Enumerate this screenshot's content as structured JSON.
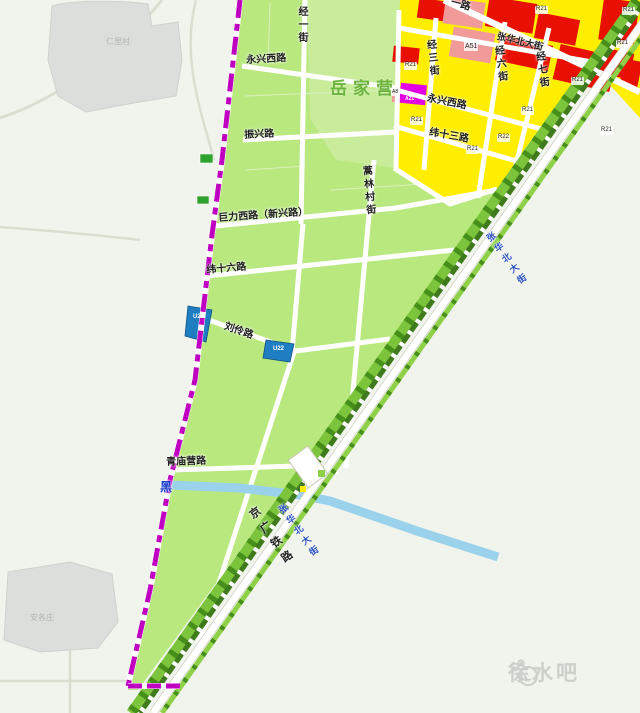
{
  "villages": {
    "yuejiaying": "岳家营",
    "renlicun": "仁里村",
    "angezhuang": "安各庄"
  },
  "roads": {
    "yongxing_west": "永兴西路",
    "zhenxing": "振兴路",
    "juli_west": "巨力西路（新兴路）",
    "wei_16": "纬十六路",
    "liuling": "刘伶路",
    "qingmiaoying": "青庙营路",
    "wei_13": "纬十三路",
    "jing_1": "经一街",
    "jing_3": "经三街",
    "jing_6": "经六街",
    "jing_7": "经七街",
    "haolin_village_st": "蒿林村街",
    "zhanghua_north": "张华北大街",
    "top_partial": "一路"
  },
  "railway": {
    "label": "京广铁路"
  },
  "river": {
    "label": "黑"
  },
  "watermark": {
    "text": "徐水吧"
  },
  "parcel_codes": [
    "A51",
    "U21",
    "U22",
    "A8",
    "A21",
    "R21",
    "R21",
    "R21",
    "R22",
    "R21",
    "R21",
    "R21",
    "R21",
    "R21",
    "R21"
  ],
  "legend_colors": {
    "residential_yellow": "#ffee00",
    "commercial_red": "#e81000",
    "mixed_pink": "#f19a9a",
    "special_magenta": "#e400e4",
    "utility_blue": "#1f7ec2",
    "green_space": "#b9e87e",
    "village_green": "#c9ec9b",
    "water_blue": "#9ad2ec",
    "boundary_magenta": "#c000c0",
    "rail_corridor_green": "#7cc43c"
  }
}
